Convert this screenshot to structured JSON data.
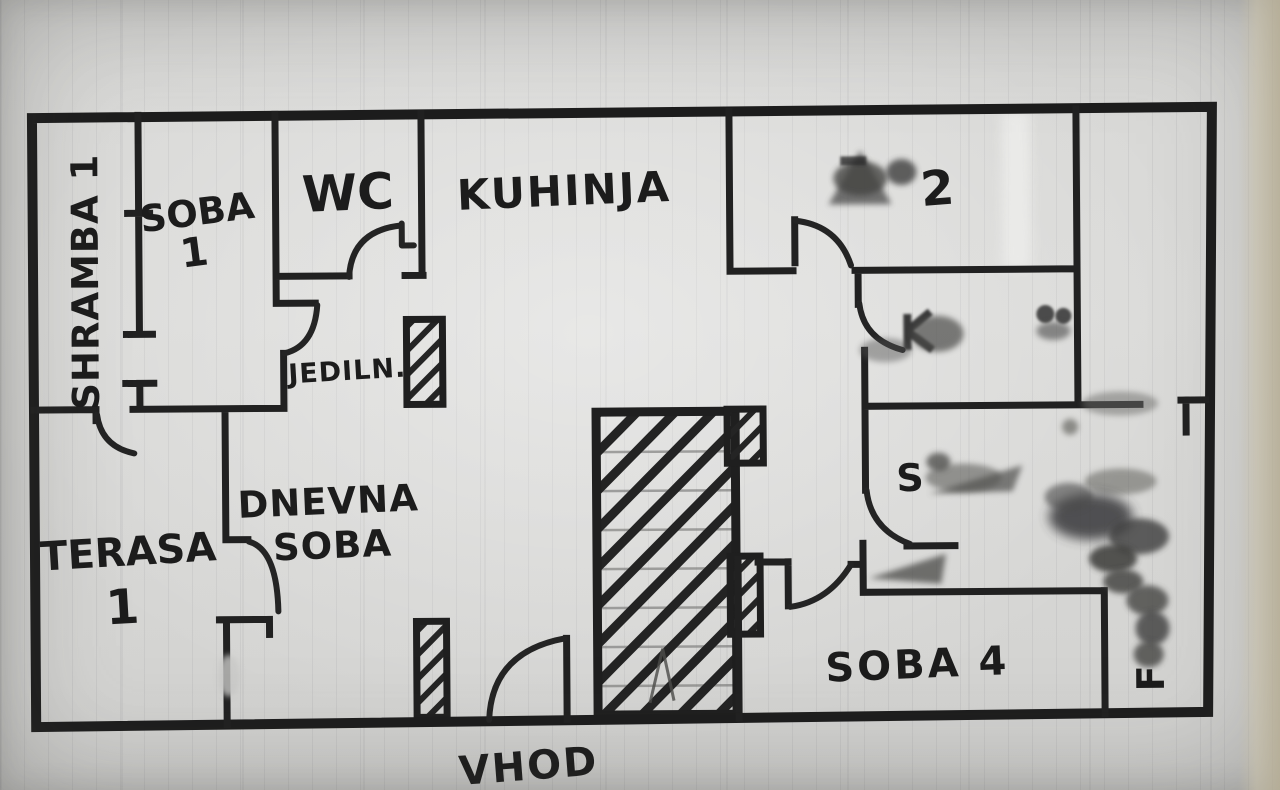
{
  "photo": {
    "description_colors": {
      "ink": "#212121",
      "paper": "#d8d8d6"
    }
  },
  "plan": {
    "rooms": {
      "shramba1": {
        "label": "SHRAMBA 1"
      },
      "soba1": {
        "line1": "SOBA",
        "line2": "1"
      },
      "wc": {
        "label": "WC"
      },
      "kuhinja": {
        "label": "KUHINJA"
      },
      "soba2": {
        "visible_digit": "2"
      },
      "jedilnica": {
        "label": "JEDILN."
      },
      "dnevna": {
        "line1": "DNEVNA",
        "line2": "SOBA"
      },
      "terasa1": {
        "line1": "TERASA",
        "line2": "1"
      },
      "soba3": {
        "visible_letter": "S"
      },
      "soba4": {
        "label": "SOBA 4"
      },
      "redacted_strip": {
        "visible_letter": "F"
      }
    },
    "entrance": {
      "label": "VHOD"
    }
  }
}
